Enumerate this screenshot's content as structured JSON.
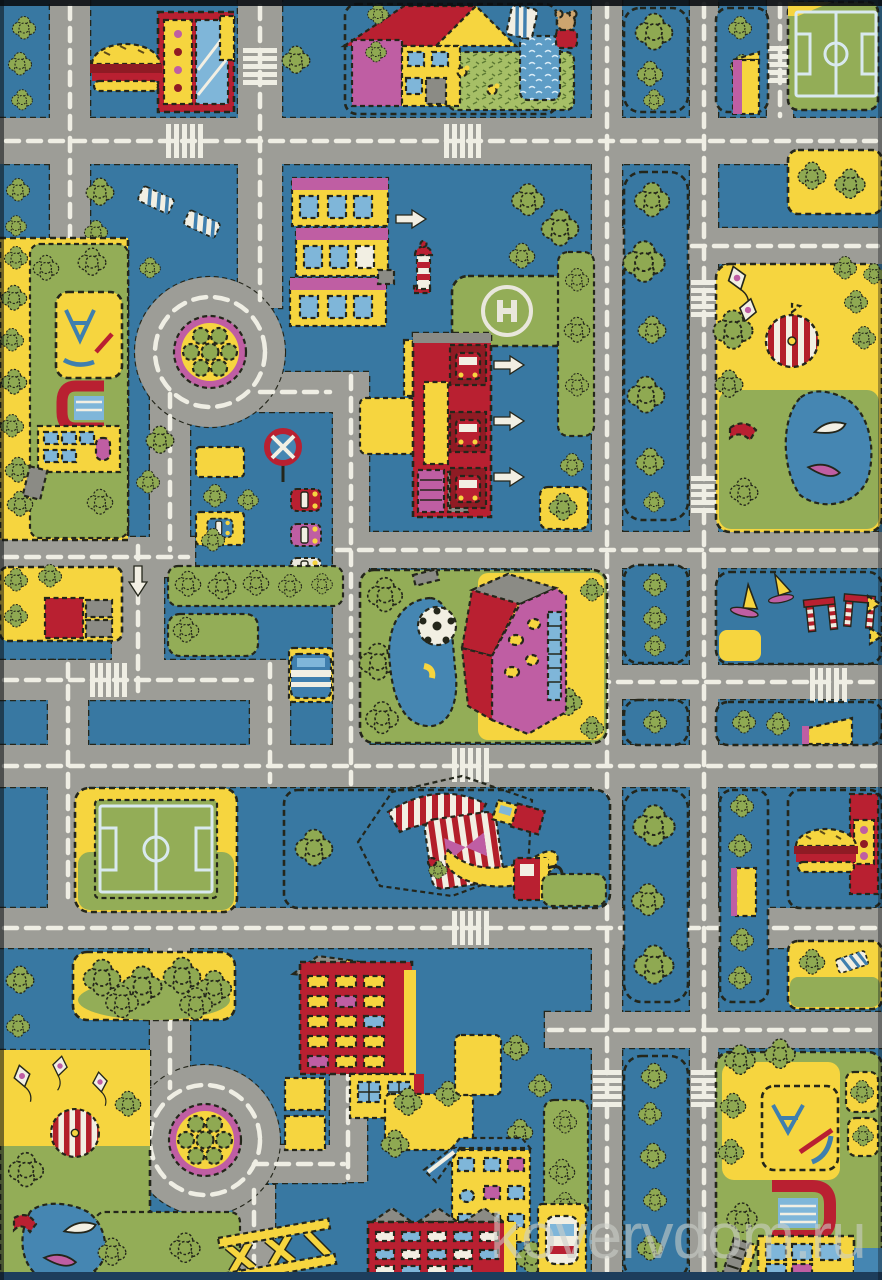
{
  "photo": {
    "subject": "children's city-roads play rug, top-down cartoon street map",
    "orientation": "portrait"
  },
  "watermark": {
    "text": "kovervdom.ru"
  },
  "palette": {
    "background_blue": "#3878a2",
    "road_gray": "#9d9d97",
    "marking_white": "#efeee4",
    "block_yellow": "#f6d53f",
    "grass_green": "#93ad57",
    "tree_green": "#8fa952",
    "building_red": "#b92031",
    "dark_red": "#8f1b24",
    "accent_magenta": "#bf5ea3",
    "light_blue": "#7fb6d9",
    "water_blue": "#4586b2",
    "outline_black": "#24261b",
    "cream_white": "#f2efe3",
    "tent_red": "#b31f2a"
  },
  "landmarks": [
    {
      "id": "burger-kiosk-top",
      "label": "burger fast-food kiosk"
    },
    {
      "id": "house-with-garden",
      "label": "house with garden, ducks and pond"
    },
    {
      "id": "teddy-bear",
      "label": "teddy bear toy"
    },
    {
      "id": "soccer-field-top",
      "label": "soccer field"
    },
    {
      "id": "roundabout-top",
      "label": "roundabout with flower bed"
    },
    {
      "id": "roundabout-bottom",
      "label": "roundabout with flower bed"
    },
    {
      "id": "shops-row",
      "label": "row of shop buildings"
    },
    {
      "id": "helipad",
      "label": "helipad with H marking"
    },
    {
      "id": "lighthouse-tower",
      "label": "small striped tower"
    },
    {
      "id": "fire-station",
      "label": "fire station with truck bays and exit arrows"
    },
    {
      "id": "no-stopping-sign",
      "label": "no-stopping road sign"
    },
    {
      "id": "parked-cars",
      "label": "parked cars"
    },
    {
      "id": "bus-stop",
      "label": "bus stop pocket"
    },
    {
      "id": "playground-left",
      "label": "playground with climbing frames"
    },
    {
      "id": "school-left",
      "label": "school with red arch entrance"
    },
    {
      "id": "amusement-park",
      "label": "park with carousel, kites and boat pond"
    },
    {
      "id": "sports-club",
      "label": "club building with soccer-ball pond"
    },
    {
      "id": "windsurf-lot",
      "label": "lot with sail boards and striped goals"
    },
    {
      "id": "soccer-field-bottom",
      "label": "soccer field"
    },
    {
      "id": "circus-tent",
      "label": "red-white circus tent"
    },
    {
      "id": "gas-pump",
      "label": "fuel pump"
    },
    {
      "id": "burger-kiosk-right",
      "label": "burger fast-food kiosk"
    },
    {
      "id": "forest-grove",
      "label": "grove of trees"
    },
    {
      "id": "apartment-block",
      "label": "red apartment block"
    },
    {
      "id": "boat-pond-bottom-left",
      "label": "playground pond with boats and slide"
    },
    {
      "id": "construction-frame",
      "label": "yellow frame structure"
    },
    {
      "id": "houses-bottom",
      "label": "houses with blue roofs"
    },
    {
      "id": "school-right",
      "label": "school with red arch entrance"
    },
    {
      "id": "playground-right",
      "label": "playground with climbing frames"
    },
    {
      "id": "tree-lined-boulevard",
      "label": "tree-lined boulevard"
    },
    {
      "id": "road-network",
      "label": "gray roads with white markings"
    }
  ]
}
